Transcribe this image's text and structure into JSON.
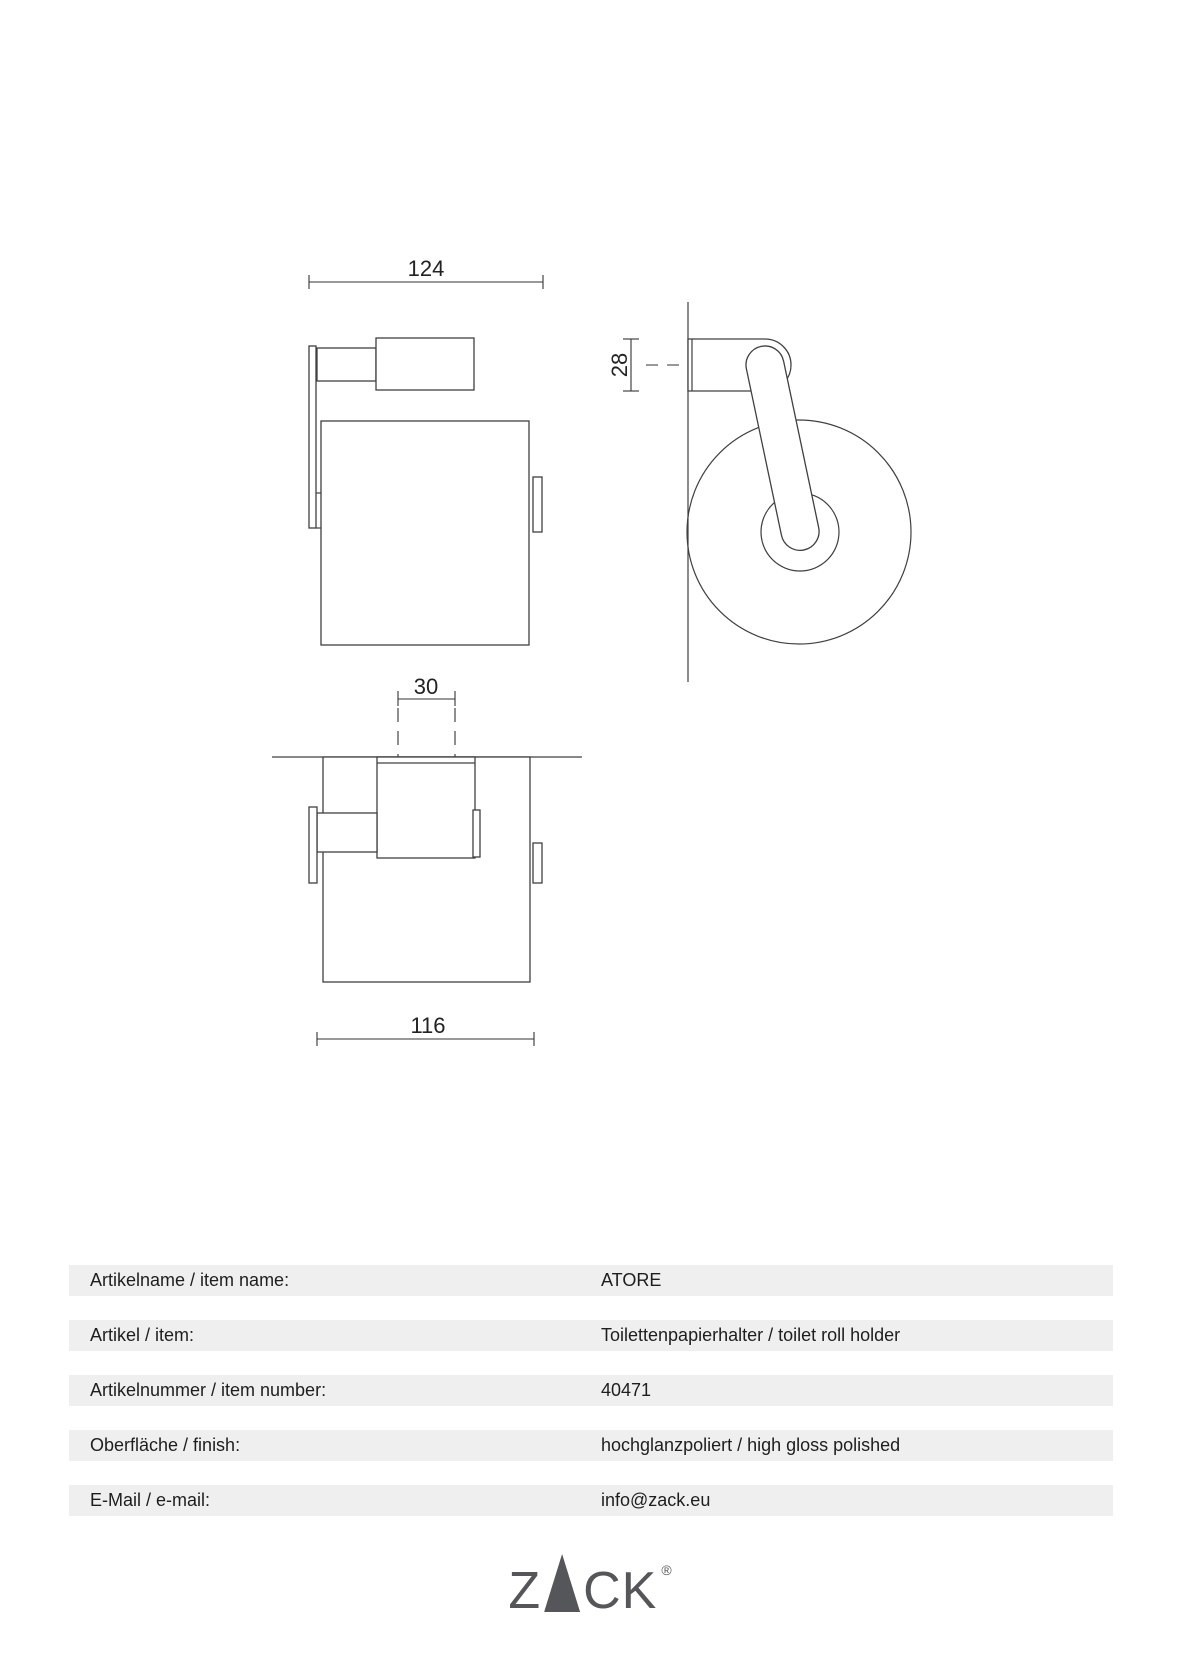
{
  "drawing": {
    "front_view": {
      "width_dim": "124"
    },
    "side_view": {
      "bracket_dim": "28"
    },
    "top_view": {
      "plate_dim": "30",
      "width_dim": "116"
    }
  },
  "spec_table": {
    "rows": [
      {
        "label": "Artikelname / item name:",
        "value": "ATORE"
      },
      {
        "label": "Artikel / item:",
        "value": "Toilettenpapierhalter / toilet roll holder"
      },
      {
        "label": "Artikelnummer / item number:",
        "value": "40471"
      },
      {
        "label": "Oberfläche / finish:",
        "value": "hochglanzpoliert / high gloss polished"
      },
      {
        "label": "E-Mail / e-mail:",
        "value": "info@zack.eu"
      }
    ]
  },
  "logo": {
    "part1": "Z",
    "part2": "C",
    "part3": "K",
    "registered": "®"
  },
  "colors": {
    "line": "#404040",
    "table_row_bg": "#efefef",
    "text": "#1e1e1e",
    "logo": "#55565a"
  }
}
